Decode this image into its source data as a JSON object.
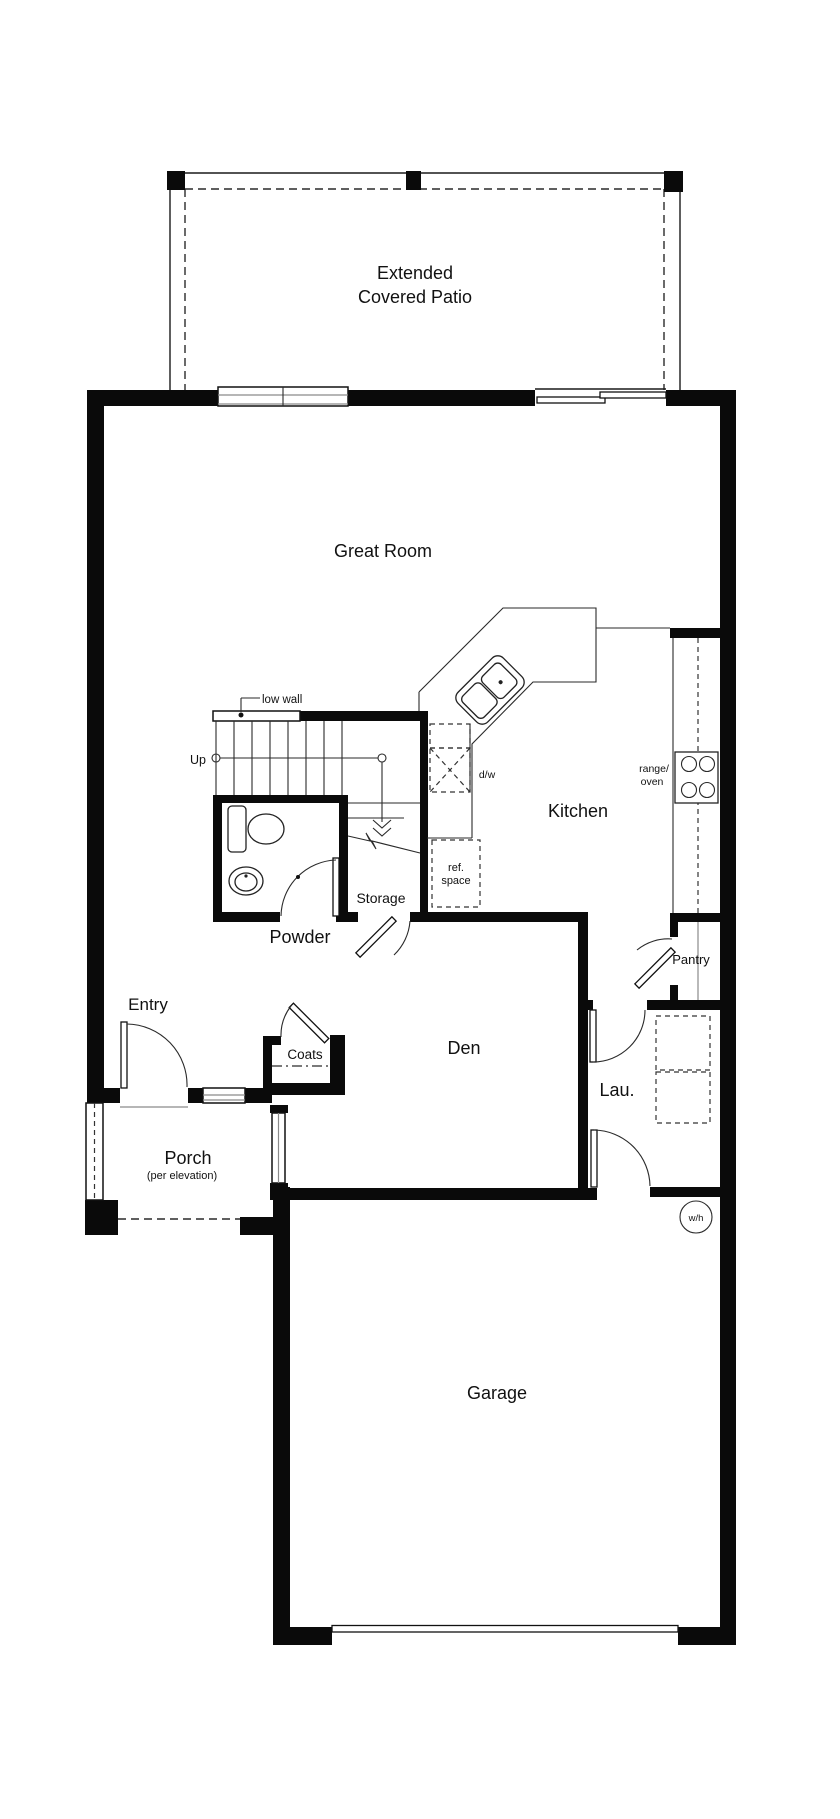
{
  "document": {
    "type": "architectural floor plan",
    "level": "first floor"
  },
  "colors": {
    "background": "#ffffff",
    "wall": "#0a0a0a",
    "line": "#1a1a1a",
    "window_gray": "#8a8a8a",
    "dashed": "#2a2a2a",
    "text": "#111111"
  },
  "labels": {
    "patio_line1": "Extended",
    "patio_line2": "Covered Patio",
    "great_room": "Great Room",
    "low_wall": "low wall",
    "up": "Up",
    "dishwasher": "d/w",
    "range_line1": "range/",
    "range_line2": "oven",
    "kitchen": "Kitchen",
    "ref_line1": "ref.",
    "ref_line2": "space",
    "storage": "Storage",
    "powder": "Powder",
    "pantry": "Pantry",
    "entry": "Entry",
    "coats": "Coats",
    "den": "Den",
    "laundry": "Lau.",
    "porch": "Porch",
    "porch_note": "(per elevation)",
    "water_heater": "w/h",
    "garage": "Garage"
  },
  "symbols": [
    "patio-posts",
    "double-window",
    "sliding-glass-door",
    "stair-run-up-arrow",
    "low-wall",
    "toilet",
    "pedestal-sink",
    "kitchen-corner-sink",
    "range-oven-4-burners",
    "dishwasher-dashed",
    "refrigerator-space-dashed",
    "washer-dryer-dashed",
    "water-heater-circle",
    "door-swing-arcs",
    "garage-door",
    "porch-open-edge-dashed"
  ]
}
